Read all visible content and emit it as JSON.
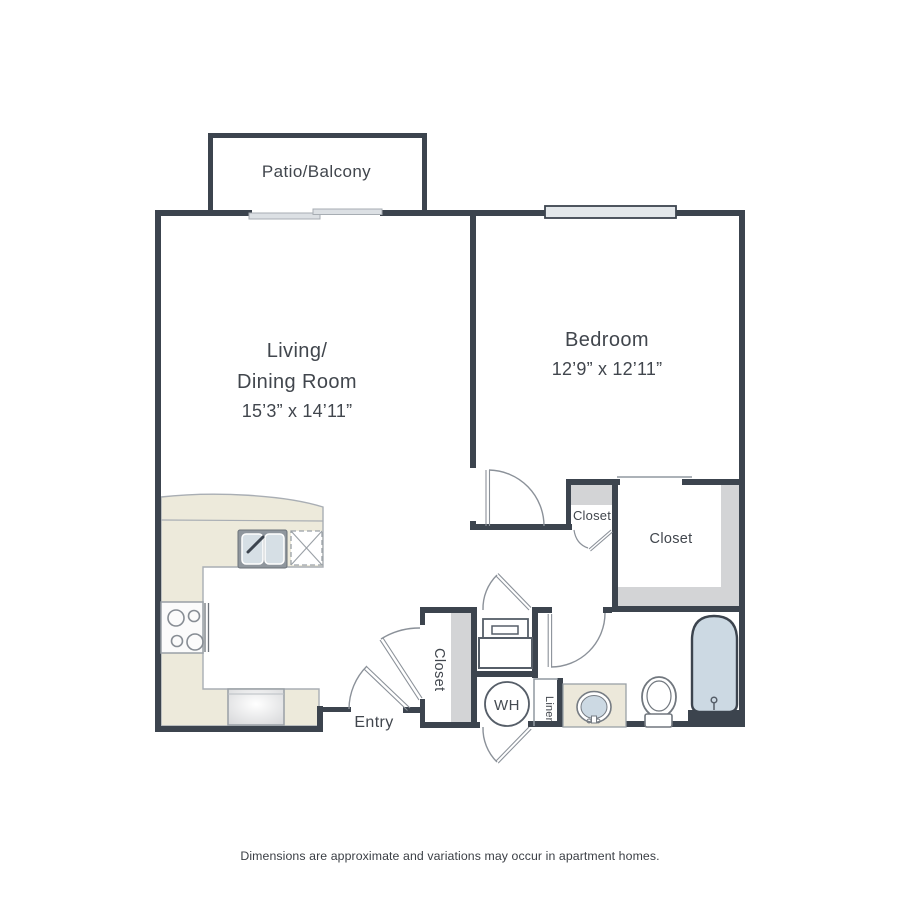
{
  "floorplan": {
    "patio_label": "Patio/Balcony",
    "living": {
      "name_line1": "Living/",
      "name_line2": "Dining Room",
      "dims": "15’3” x 14’11”"
    },
    "bedroom": {
      "name": "Bedroom",
      "dims": "12’9” x 12’11”"
    },
    "bedroom_closet_label": "Closet",
    "walkin_closet_label": "Closet",
    "hall_closet_label": "Closet",
    "linen_label": "Linen",
    "entry_label": "Entry",
    "water_heater_label": "WH",
    "disclaimer": "Dimensions are approximate and variations may occur in apartment homes.",
    "fixtures": {
      "kitchen": [
        "kitchen-counter",
        "double-sink",
        "stove",
        "refrigerator",
        "dishwasher-dashed-box"
      ],
      "utility": [
        "washer-dryer",
        "water-heater"
      ],
      "bathroom": [
        "vanity-sink",
        "toilet",
        "bathtub"
      ],
      "openings": [
        "patio-sliding-door",
        "bedroom-window",
        "entry-door",
        "bedroom-door",
        "bathroom-door",
        "hall-closet-door",
        "utility-closet-door",
        "wh-access-door",
        "bifold-closet-door"
      ]
    },
    "colors": {
      "wall": "#3c444e",
      "counter": "#edeadb",
      "closet_shading": "#d3d4d6",
      "fixture_blue": "#ccd9e3",
      "thin_line": "#8b9199"
    }
  }
}
